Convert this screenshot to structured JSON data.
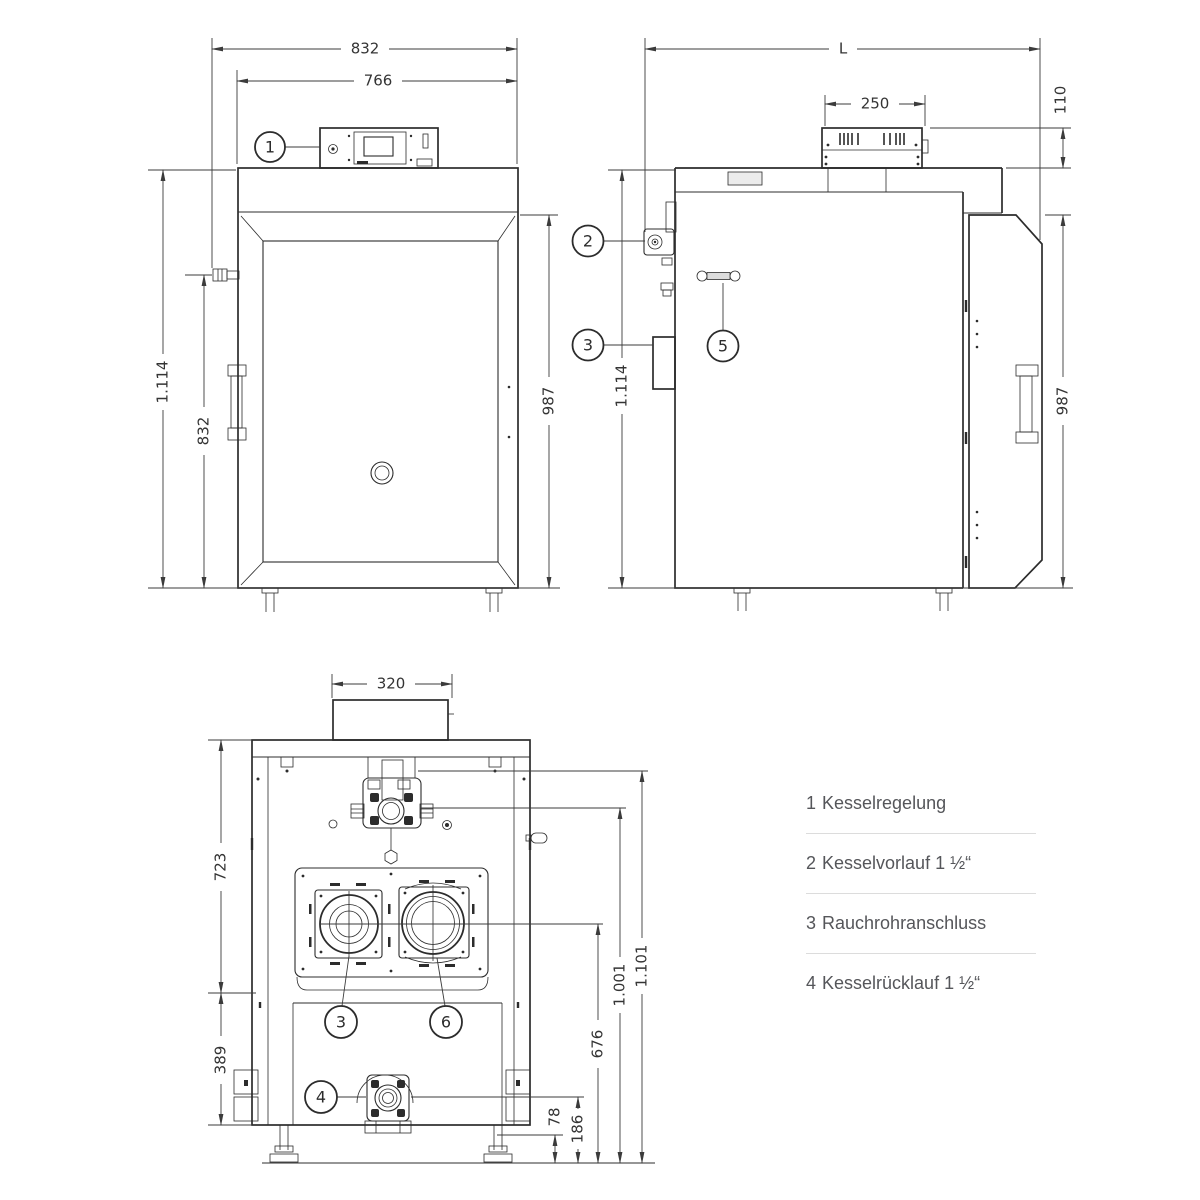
{
  "drawing": {
    "front": {
      "dim_width_outer": "832",
      "dim_width_inner": "766",
      "dim_height_total": "1.114",
      "dim_height_side": "832",
      "dim_height_door": "987",
      "callout_regelung": "1"
    },
    "side": {
      "dim_length": "L",
      "dim_panel_width": "250",
      "dim_panel_height": "110",
      "dim_height_total": "1.114",
      "dim_height_door": "987",
      "callout_vorlauf": "2",
      "callout_rauchrohr": "3",
      "callout_handle": "5"
    },
    "rear": {
      "dim_duct_width": "320",
      "dim_height_upper": "723",
      "dim_height_lower": "389",
      "dim_flue_center": "676",
      "dim_conn_upper": "1.001",
      "dim_conn_top": "1.101",
      "dim_ruecklauf_low": "78",
      "dim_ruecklauf_center": "186",
      "callout_rauchrohr": "3",
      "callout_opening": "6",
      "callout_ruecklauf": "4"
    }
  },
  "legend": {
    "items": [
      {
        "num": "1",
        "label": "Kesselregelung"
      },
      {
        "num": "2",
        "label": "Kesselvorlauf 1 ½“"
      },
      {
        "num": "3",
        "label": "Rauchrohranschluss"
      },
      {
        "num": "4",
        "label": "Kesselrücklauf 1 ½“"
      }
    ]
  }
}
